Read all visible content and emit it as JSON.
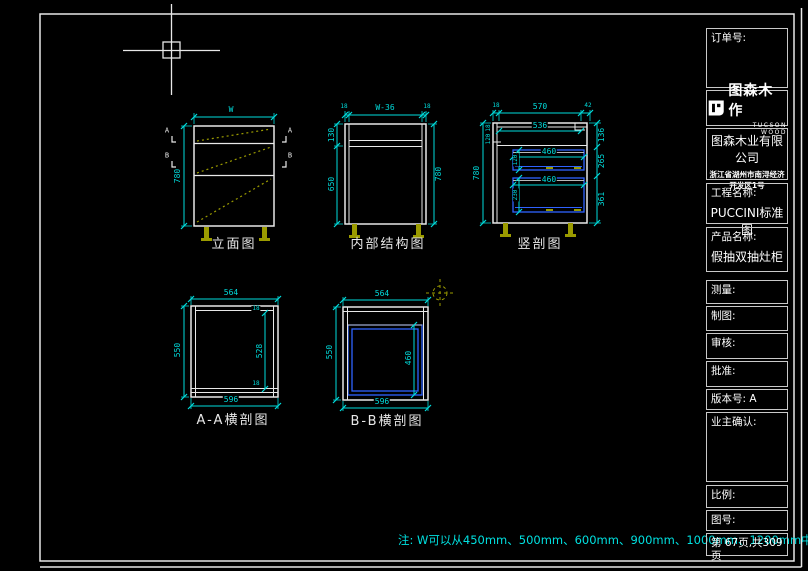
{
  "title_block": {
    "order_label": "订单号:",
    "logo": {
      "name": "图森木作",
      "subname": "TUCSON WOOD"
    },
    "company": "图森木业有限公司",
    "address_line1": "浙江省湖州市南浔经济",
    "address_line2": "开发区1号",
    "project_label": "工程名称:",
    "project_value": "PUCCINI标准图",
    "product_label": "产品名称:",
    "product_value": "假抽双抽灶柜",
    "measure_label": "测量:",
    "draft_label": "制图:",
    "review_label": "审核:",
    "approve_label": "批准:",
    "version_label": "版本号:",
    "version_value": "A",
    "owner_label": "业主确认:",
    "scale_label": "比例:",
    "drawing_no_label": "图号:",
    "page_info": "第 67页,共309页"
  },
  "note": "注: W可以从450mm、500mm、600mm、900mm、1000mm、1200mm中选择。",
  "views": {
    "elevation": {
      "label": "立面图",
      "dim_width": "W",
      "dim_height": "780",
      "marker_a": "A",
      "marker_b": "B"
    },
    "internal": {
      "label": "内部结构图",
      "dim_top_left": "18",
      "dim_top_center": "W-36",
      "dim_top_right": "18",
      "dim_left_top": "130",
      "dim_left_bottom": "650",
      "dim_right": "780"
    },
    "section": {
      "label": "竖剖图",
      "dim_top_left": "18",
      "dim_top_center": "570",
      "dim_top_right": "42",
      "dim_inner_width": "536",
      "dim_drawer1_width": "460",
      "dim_drawer2_width": "460",
      "dim_drawer1_height": "120",
      "dim_drawer2_height": "230",
      "dim_right_top": "136",
      "dim_right_mid": "265",
      "dim_right_bottom": "361",
      "dim_left": "780",
      "dim_left_small_a": "18",
      "dim_left_small_b": "120"
    },
    "section_aa": {
      "label": "A-A横剖图",
      "dim_top": "564",
      "dim_bottom": "596",
      "dim_left": "550",
      "dim_right_top": "18",
      "dim_right_mid": "528",
      "dim_right_bottom": "18"
    },
    "section_bb": {
      "label": "B-B横剖图",
      "dim_top": "564",
      "dim_bottom": "596",
      "dim_left": "550",
      "dim_inner": "460"
    }
  },
  "colors": {
    "dimension": "#00dcdc",
    "outline": "#e8e8e8",
    "drawer": "#2f62ff",
    "hidden_line": "#9b9b00",
    "text": "#ffffff"
  }
}
